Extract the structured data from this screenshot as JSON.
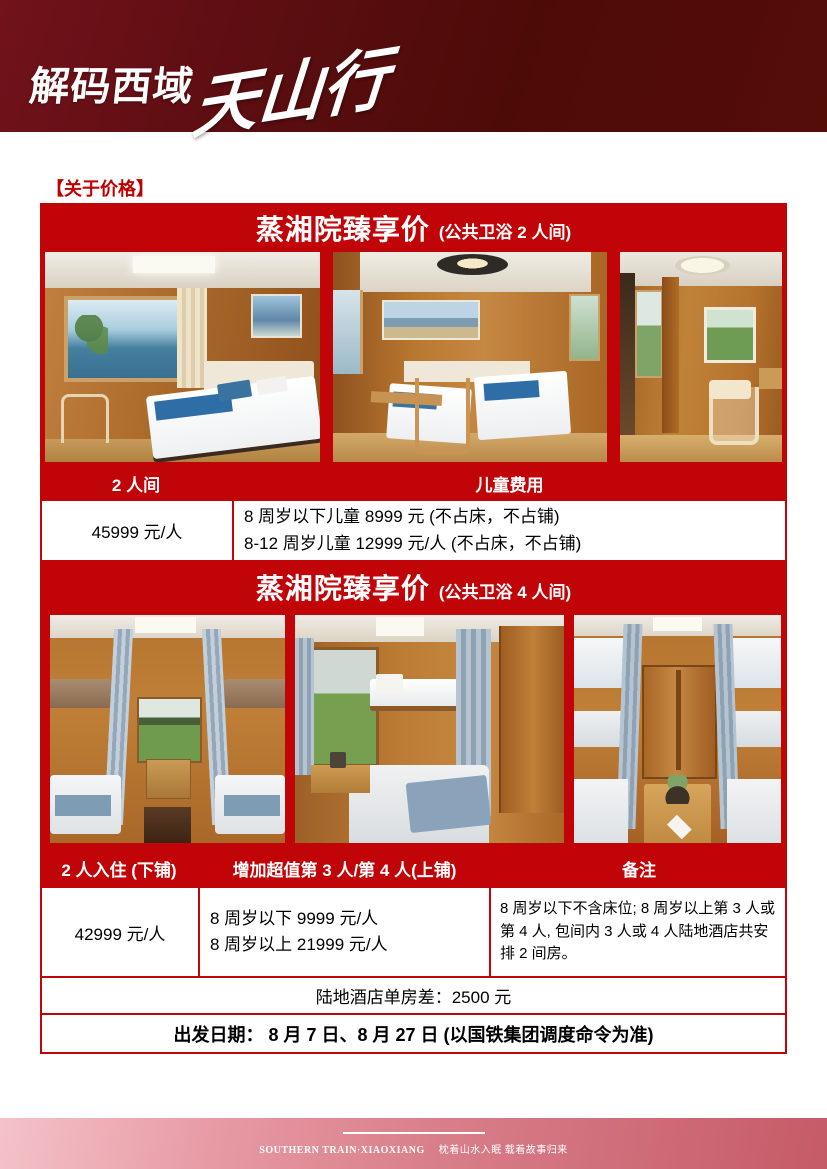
{
  "header": {
    "logo_bold": "解码西域",
    "logo_script": "天山行"
  },
  "section_label": "【关于价格】",
  "block1": {
    "title": "蒸湘院臻享价",
    "subtitle": "(公共卫浴 2 人间)",
    "photos": [
      {
        "label": "木质双人间·海景车窗与双床"
      },
      {
        "label": "木质双人间·书桌座椅与双床"
      },
      {
        "label": "木质过道·休闲椅与挂画"
      }
    ],
    "table": {
      "col1_header": "2 人间",
      "col2_header": "儿童费用",
      "price": "45999 元/人",
      "child_line1": "8 周岁以下儿童 8999 元 (不占床，不占铺)",
      "child_line2": "8-12 周岁儿童 12999 元/人 (不占床，不占铺)"
    }
  },
  "block2": {
    "title": "蒸湘院臻享价",
    "subtitle": "(公共卫浴 4 人间)",
    "photos": [
      {
        "label": "四人间·对称上下铺与田野车窗"
      },
      {
        "label": "四人间·车窗小桌与上下铺"
      },
      {
        "label": "四人间·蓝帘上下铺与木柜小桌"
      }
    ],
    "table": {
      "col1_header": "2 人入住 (下铺)",
      "col2_header": "增加超值第 3 人/第 4 人(上铺)",
      "col3_header": "备注",
      "price": "42999 元/人",
      "extra_line1": "8 周岁以下 9999 元/人",
      "extra_line2": "8 周岁以上 21999 元/人",
      "note": "8 周岁以下不含床位; 8 周岁以上第 3 人或第 4 人, 包间内 3 人或 4 人陆地酒店共安排 2 间房。"
    }
  },
  "notes": {
    "single_room_diff": "陆地酒店单房差：2500 元",
    "departure": "出发日期：  8 月 7 日、8 月 27 日 (以国铁集团调度命令为准)"
  },
  "footer": {
    "brand": "SOUTHERN TRAIN·XIAOXIANG",
    "slogan": "枕着山水入眠 载着故事归来"
  },
  "colors": {
    "banner_red": "#c10407",
    "label_red": "#c00000",
    "masthead_left": "#72121b",
    "masthead_right": "#550d08",
    "footer_pink_light": "#f4c2c9",
    "footer_pink_dark": "#c55b67"
  }
}
